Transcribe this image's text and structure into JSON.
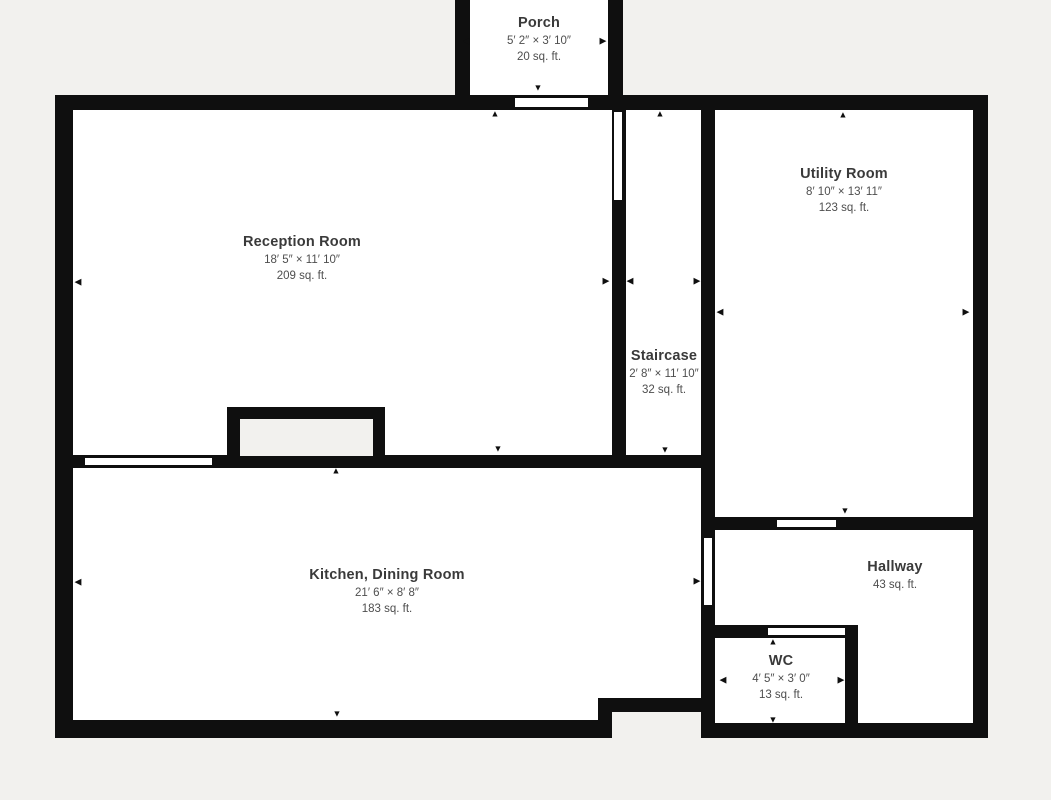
{
  "palette": {
    "background": "#f2f1ee",
    "wall": "#0f0f0f",
    "room_fill": "#ffffff",
    "room_name_color": "#3a3a3a",
    "dimension_color": "#4e4e4e"
  },
  "rooms": {
    "porch": {
      "name": "Porch",
      "dims": "5′ 2″ × 3′ 10″",
      "area": "20 sq. ft."
    },
    "reception": {
      "name": "Reception Room",
      "dims": "18′ 5″ × 11′ 10″",
      "area": "209 sq. ft."
    },
    "staircase": {
      "name": "Staircase",
      "dims": "2′ 8″ × 11′ 10″",
      "area": "32 sq. ft."
    },
    "utility": {
      "name": "Utility Room",
      "dims": "8′ 10″ × 13′ 11″",
      "area": "123 sq. ft."
    },
    "kitchen": {
      "name": "Kitchen, Dining Room",
      "dims": "21′ 6″ × 8′ 8″",
      "area": "183 sq. ft."
    },
    "hallway": {
      "name": "Hallway",
      "area": "43 sq. ft."
    },
    "wc": {
      "name": "WC",
      "dims": "4′ 5″ × 3′ 0″",
      "area": "13 sq. ft."
    }
  },
  "icons": {
    "arrow_up": "▲",
    "arrow_down": "▼",
    "arrow_left": "◀",
    "arrow_right": "▶"
  }
}
